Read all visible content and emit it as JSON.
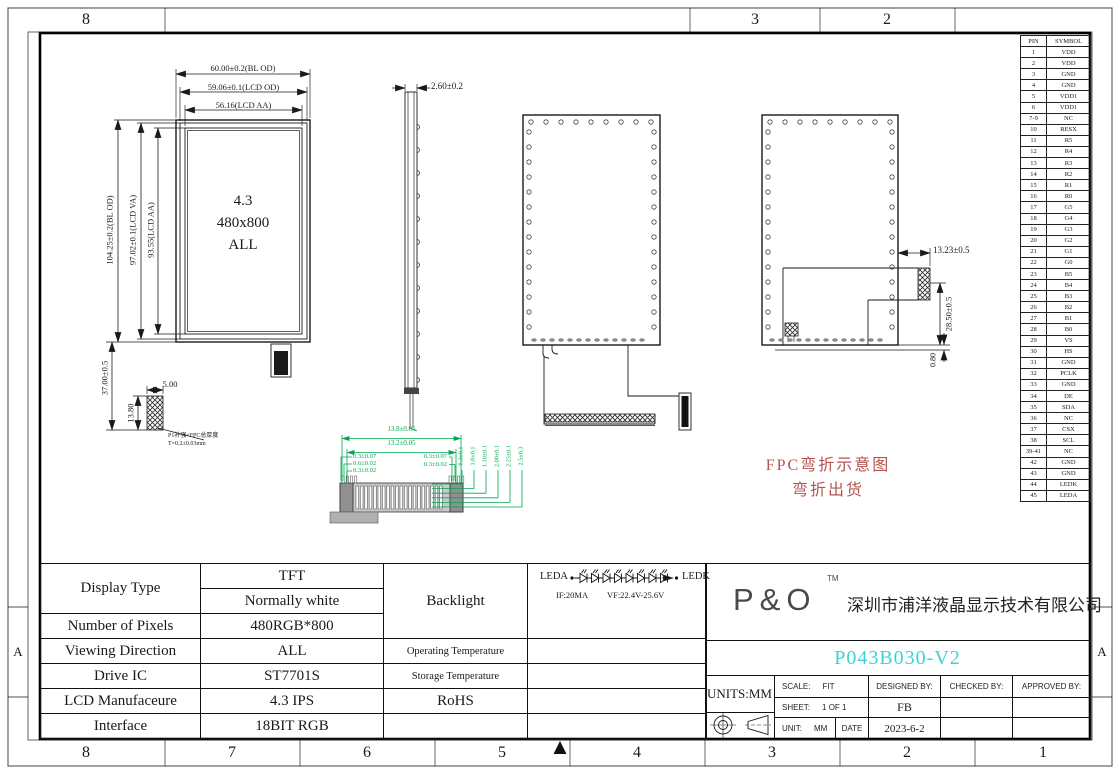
{
  "border": {
    "top_labels": [
      "8",
      "3",
      "2"
    ],
    "bottom_labels": [
      "8",
      "7",
      "6",
      "5",
      "4",
      "3",
      "2",
      "1"
    ],
    "row_label": "A"
  },
  "pin_table": {
    "headers": [
      "PIN",
      "SYMBOL"
    ],
    "rows": [
      [
        "1",
        "VDD"
      ],
      [
        "2",
        "VDD"
      ],
      [
        "3",
        "GND"
      ],
      [
        "4",
        "GND"
      ],
      [
        "5",
        "VDD1"
      ],
      [
        "6",
        "VDD1"
      ],
      [
        "7-9",
        "NC"
      ],
      [
        "10",
        "RESX"
      ],
      [
        "11",
        "R5"
      ],
      [
        "12",
        "R4"
      ],
      [
        "13",
        "R3"
      ],
      [
        "14",
        "R2"
      ],
      [
        "15",
        "R1"
      ],
      [
        "16",
        "R0"
      ],
      [
        "17",
        "G5"
      ],
      [
        "18",
        "G4"
      ],
      [
        "19",
        "G3"
      ],
      [
        "20",
        "G2"
      ],
      [
        "21",
        "G1"
      ],
      [
        "22",
        "G0"
      ],
      [
        "23",
        "B5"
      ],
      [
        "24",
        "B4"
      ],
      [
        "25",
        "B3"
      ],
      [
        "26",
        "B2"
      ],
      [
        "27",
        "B1"
      ],
      [
        "28",
        "B0"
      ],
      [
        "29",
        "VS"
      ],
      [
        "30",
        "HS"
      ],
      [
        "31",
        "GND"
      ],
      [
        "32",
        "PCLK"
      ],
      [
        "33",
        "GND"
      ],
      [
        "34",
        "DE"
      ],
      [
        "35",
        "SDA"
      ],
      [
        "36",
        "NC"
      ],
      [
        "37",
        "CSX"
      ],
      [
        "38",
        "SCL"
      ],
      [
        "39-41",
        "NC"
      ],
      [
        "42",
        "GND"
      ],
      [
        "43",
        "GND"
      ],
      [
        "44",
        "LEDK"
      ],
      [
        "45",
        "LEDA"
      ]
    ]
  },
  "front_view": {
    "dim_bl_w": "60.00±0.2(BL OD)",
    "dim_lcd_w": "59.06±0.1(LCD OD)",
    "dim_aa_w": "56.16(LCD AA)",
    "dim_bl_h": "104.25±0.2(BL OD)",
    "dim_va_h": "97.02±0.1(LCD VA)",
    "dim_aa_h": "93.55(LCD AA)",
    "dim_fpc_len": "37.00±0.5",
    "dim_stiffener_h": "13.80",
    "dim_stiffener_w": "5.00",
    "label_size": "4.3",
    "label_res": "480x800",
    "label_view": "ALL",
    "note_line1": "P1补强+FPC总厚度",
    "note_line2": "T=0.2±0.03mm"
  },
  "side_view": {
    "dim_thickness": "2.60±0.2"
  },
  "back_view": {
    "dim_offset": "13.23±0.5",
    "dim_height": "28.50±0.5",
    "dim_gap": "0.80"
  },
  "connector_detail": {
    "dim_outer": "13.8±0.05",
    "dim_inner": "13.2±0.05",
    "left_dims": [
      "0.3±0.07",
      "0.6±0.02",
      "0.3±0.02"
    ],
    "right_dims": [
      "0.3±0.07",
      "0.3±0.02"
    ],
    "stack_dims": [
      "0.3±0.1",
      "1.0±0.1",
      "1.10±0.1",
      "2.00±0.1",
      "2.25±0.1",
      "2.5±0.3"
    ]
  },
  "led_circuit": {
    "anode": "LEDA",
    "cathode": "LEDK",
    "current": "IF:20MA",
    "voltage": "VF:22.4V-25.6V"
  },
  "fpc_note": {
    "line1": "FPC弯折示意图",
    "line2": "弯折出货"
  },
  "spec_table": {
    "display_type_label": "Display Type",
    "display_type_value1": "TFT",
    "display_type_value2": "Normally white",
    "backlight_label": "Backlight",
    "pixels_label": "Number of Pixels",
    "pixels_value": "480RGB*800",
    "viewing_label": "Viewing Direction",
    "viewing_value": "ALL",
    "op_temp_label": "Operating Temperature",
    "drive_label": "Drive IC",
    "drive_value": "ST7701S",
    "st_temp_label": "Storage Temperature",
    "mfr_label": "LCD Manufaceure",
    "mfr_value": "4.3 IPS",
    "rohs_label": "RoHS",
    "iface_label": "Interface",
    "iface_value": "18BIT RGB"
  },
  "title_block": {
    "logo": "P&O",
    "tm": "TM",
    "company": "深圳市浦洋液晶显示技术有限公司",
    "part_number": "P043B030-V2",
    "units": "UNITS:MM",
    "scale_label": "SCALE:",
    "scale_value": "FIT",
    "designed_label": "DESIGNED BY:",
    "checked_label": "CHECKED BY:",
    "approved_label": "APPROVED BY:",
    "sheet_label": "SHEET:",
    "sheet_value": "1 OF 1",
    "designer": "FB",
    "unit_label": "UNIT:",
    "unit_value": "MM",
    "date_label": "DATE",
    "date_value": "2023-6-2"
  },
  "colors": {
    "green": "#00a84f",
    "red": "#b5524e",
    "cyan": "#3bd2da",
    "line": "#1a1a1a"
  }
}
